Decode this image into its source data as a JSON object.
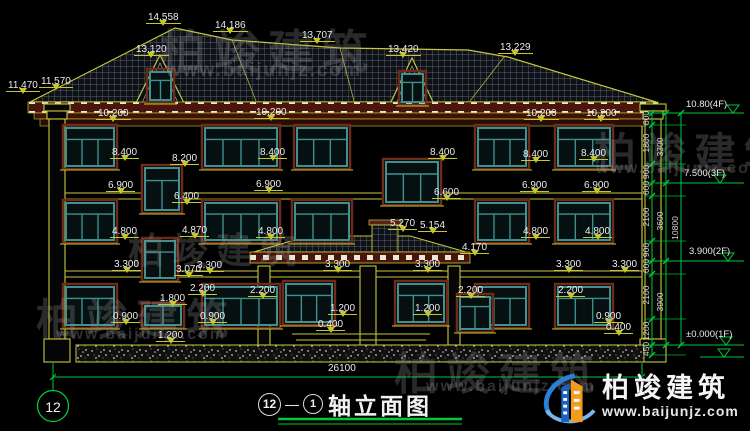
{
  "drawing": {
    "title": {
      "axis_start": "12",
      "axis_end": "1",
      "name": "轴立面图"
    },
    "axis_bubble_label": "12",
    "levels": [
      {
        "t": "10.80(4F)",
        "x": 686,
        "y": 99
      },
      {
        "t": "7.500(3F)",
        "x": 684,
        "y": 168
      },
      {
        "t": "3.900(2F)",
        "x": 689,
        "y": 246
      },
      {
        "t": "±0.000(1F)",
        "x": 686,
        "y": 329
      }
    ],
    "dims": [
      {
        "t": "14.558",
        "x": 146,
        "y": 12
      },
      {
        "t": "14.186",
        "x": 213,
        "y": 20
      },
      {
        "t": "13.120",
        "x": 134,
        "y": 44
      },
      {
        "t": "13.707",
        "x": 300,
        "y": 30
      },
      {
        "t": "13.420",
        "x": 386,
        "y": 44
      },
      {
        "t": "13.229",
        "x": 498,
        "y": 42
      },
      {
        "t": "11.470",
        "x": 6,
        "y": 80
      },
      {
        "t": "11.570",
        "x": 39,
        "y": 76
      },
      {
        "t": "10.200",
        "x": 96,
        "y": 108
      },
      {
        "t": "10.200",
        "x": 254,
        "y": 107
      },
      {
        "t": "10.200",
        "x": 524,
        "y": 108
      },
      {
        "t": "10.200",
        "x": 584,
        "y": 108
      },
      {
        "t": "8.400",
        "x": 110,
        "y": 147
      },
      {
        "t": "8.400",
        "x": 258,
        "y": 147
      },
      {
        "t": "8.400",
        "x": 428,
        "y": 147
      },
      {
        "t": "8.400",
        "x": 521,
        "y": 149
      },
      {
        "t": "8.400",
        "x": 579,
        "y": 148
      },
      {
        "t": "8.200",
        "x": 170,
        "y": 153
      },
      {
        "t": "6.900",
        "x": 106,
        "y": 180
      },
      {
        "t": "6.900",
        "x": 254,
        "y": 179
      },
      {
        "t": "6.900",
        "x": 520,
        "y": 180
      },
      {
        "t": "6.900",
        "x": 582,
        "y": 180
      },
      {
        "t": "6.600",
        "x": 432,
        "y": 187
      },
      {
        "t": "6.400",
        "x": 172,
        "y": 191
      },
      {
        "t": "4.800",
        "x": 110,
        "y": 226
      },
      {
        "t": "4.870",
        "x": 180,
        "y": 225
      },
      {
        "t": "4.800",
        "x": 256,
        "y": 226
      },
      {
        "t": "4.800",
        "x": 521,
        "y": 226
      },
      {
        "t": "4.800",
        "x": 583,
        "y": 226
      },
      {
        "t": "5.270",
        "x": 388,
        "y": 218
      },
      {
        "t": "5.154",
        "x": 418,
        "y": 220
      },
      {
        "t": "4.170",
        "x": 460,
        "y": 242
      },
      {
        "t": "3.300",
        "x": 112,
        "y": 259
      },
      {
        "t": "3.300",
        "x": 195,
        "y": 260
      },
      {
        "t": "3.070",
        "x": 174,
        "y": 264
      },
      {
        "t": "3.300",
        "x": 323,
        "y": 259
      },
      {
        "t": "3.300",
        "x": 413,
        "y": 259
      },
      {
        "t": "3.300",
        "x": 554,
        "y": 259
      },
      {
        "t": "3.300",
        "x": 610,
        "y": 259
      },
      {
        "t": "2.200",
        "x": 188,
        "y": 283
      },
      {
        "t": "2.200",
        "x": 248,
        "y": 285
      },
      {
        "t": "2.200",
        "x": 456,
        "y": 285
      },
      {
        "t": "2.200",
        "x": 556,
        "y": 285
      },
      {
        "t": "1.800",
        "x": 158,
        "y": 293
      },
      {
        "t": "0.900",
        "x": 111,
        "y": 311
      },
      {
        "t": "0.900",
        "x": 198,
        "y": 311
      },
      {
        "t": "0.900",
        "x": 594,
        "y": 311
      },
      {
        "t": "1.200",
        "x": 328,
        "y": 303
      },
      {
        "t": "1.200",
        "x": 413,
        "y": 303
      },
      {
        "t": "1.200",
        "x": 156,
        "y": 330
      },
      {
        "t": "0.400",
        "x": 316,
        "y": 319
      },
      {
        "t": "0.400",
        "x": 604,
        "y": 322
      },
      {
        "t": "26100",
        "x": 326,
        "y": 363,
        "c": "plain"
      }
    ],
    "vdims": [
      {
        "t": "600",
        "x": 629,
        "y": 113
      },
      {
        "t": "1800",
        "x": 629,
        "y": 138
      },
      {
        "t": "900",
        "x": 629,
        "y": 167
      },
      {
        "t": "600",
        "x": 629,
        "y": 183
      },
      {
        "t": "2100",
        "x": 629,
        "y": 212
      },
      {
        "t": "900",
        "x": 629,
        "y": 245
      },
      {
        "t": "600",
        "x": 629,
        "y": 261
      },
      {
        "t": "2100",
        "x": 629,
        "y": 290
      },
      {
        "t": "1200",
        "x": 629,
        "y": 326
      },
      {
        "t": "450",
        "x": 629,
        "y": 344
      },
      {
        "t": "3300",
        "x": 643,
        "y": 142
      },
      {
        "t": "3600",
        "x": 643,
        "y": 216
      },
      {
        "t": "3900",
        "x": 643,
        "y": 297
      },
      {
        "t": "10800",
        "x": 658,
        "y": 223
      }
    ]
  },
  "watermarks": [
    {
      "t": "柏竣建筑",
      "x": 160,
      "y": 16,
      "s": 46
    },
    {
      "t": "www.baijunjz.com",
      "x": 166,
      "y": 60,
      "s": 19,
      "u": 1
    },
    {
      "t": "柏竣建筑",
      "x": 594,
      "y": 120,
      "s": 42
    },
    {
      "t": "www.baijunjz.com",
      "x": 596,
      "y": 160,
      "s": 16,
      "u": 1
    },
    {
      "t": "柏竣建筑",
      "x": 128,
      "y": 222,
      "s": 36
    },
    {
      "t": "柏竣建筑",
      "x": 36,
      "y": 286,
      "s": 42
    },
    {
      "t": "www.baijunjz.com",
      "x": 56,
      "y": 326,
      "s": 16,
      "u": 1
    },
    {
      "t": "柏竣建筑",
      "x": 394,
      "y": 338,
      "s": 44
    },
    {
      "t": "www.baijunjz.com",
      "x": 426,
      "y": 378,
      "s": 16,
      "u": 1
    }
  ],
  "logo": {
    "brand": "柏竣建筑",
    "url": "www.baijunjz.com"
  },
  "colors": {
    "cad_yellow": "#c6c62e",
    "cad_green": "#00c83c",
    "window_teal": "#3f9090",
    "trim_red": "#6e2a1a",
    "logo_blue": "#1a63c0",
    "logo_orange": "#f29c1f"
  }
}
